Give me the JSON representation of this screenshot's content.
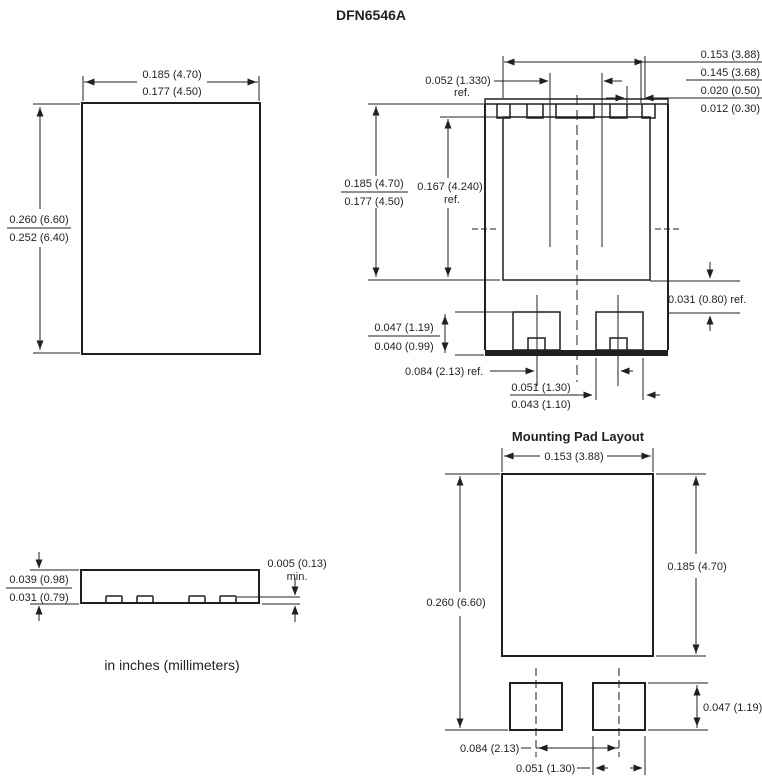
{
  "title": "DFN6546A",
  "caption": "in inches (millimeters)",
  "colors": {
    "ink": "#231f20",
    "background": "#ffffff"
  },
  "top_view": {
    "width_max": "0.185 (4.70)",
    "width_min": "0.177 (4.50)",
    "height_max": "0.260 (6.60)",
    "height_min": "0.252 (6.40)"
  },
  "bottom_view": {
    "pad_width_max": "0.153 (3.88)",
    "pad_width_min": "0.145 (3.68)",
    "pin_width_max": "0.020 (0.50)",
    "pin_width_min": "0.012 (0.30)",
    "pin_pitch": "0.052 (1.330)",
    "pin_pitch_ref": "ref.",
    "flange_len_max": "0.185 (4.70)",
    "flange_len_min": "0.177 (4.50)",
    "pad_len": "0.167 (4.240)",
    "pad_len_ref": "ref.",
    "tab_len_max": "0.047 (1.19)",
    "tab_len_min": "0.040 (0.99)",
    "tab_gap": "0.031 (0.80) ref.",
    "tab_pitch": "0.084 (2.13) ref.",
    "tab_width_max": "0.051 (1.30)",
    "tab_width_min": "0.043 (1.10)"
  },
  "side_view": {
    "height_max": "0.039 (0.98)",
    "height_min": "0.031 (0.79)",
    "standoff": "0.005 (0.13)",
    "standoff_qualifier": "min."
  },
  "pad_layout": {
    "title": "Mounting Pad Layout",
    "pad_width": "0.153 (3.88)",
    "pad_height": "0.185 (4.70)",
    "overall_height": "0.260 (6.60)",
    "tab_height": "0.047 (1.19)",
    "tab_pitch": "0.084 (2.13)",
    "tab_width": "0.051 (1.30)"
  }
}
